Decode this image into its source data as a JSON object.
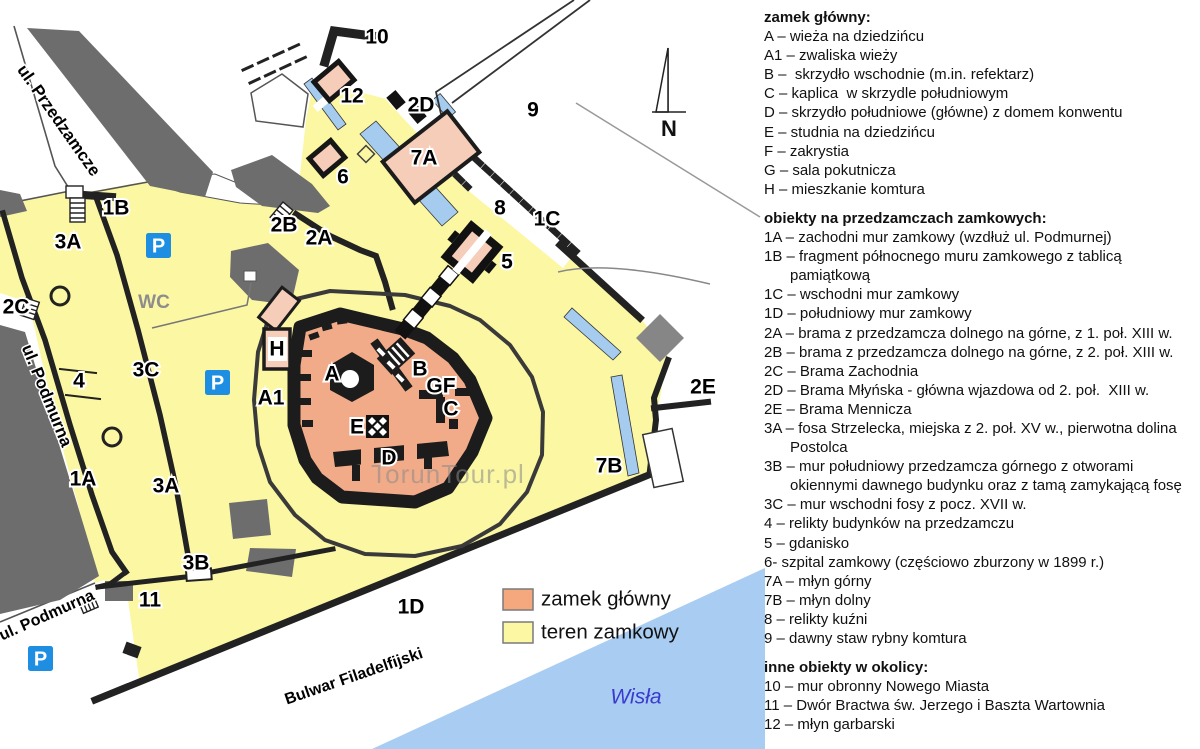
{
  "panel": {
    "sections": [
      {
        "heading": "zamek główny:",
        "lines": [
          {
            "t": "A – wieża na dziedzińcu"
          },
          {
            "t": "A1 – zwaliska wieży"
          },
          {
            "t": "B –  skrzydło wschodnie (m.in. refektarz)"
          },
          {
            "t": "C – kaplica  w skrzydle południowym"
          },
          {
            "t": "D – skrzydło południowe (główne) z domem konwentu"
          },
          {
            "t": "E – studnia na dziedzińcu"
          },
          {
            "t": "F – zakrystia"
          },
          {
            "t": "G – sala pokutnicza"
          },
          {
            "t": "H – mieszkanie komtura"
          }
        ]
      },
      {
        "heading": "obiekty na przedzamczach zamkowych:",
        "lines": [
          {
            "t": "1A – zachodni mur zamkowy (wzdłuż ul. Podmurnej)"
          },
          {
            "t": "1B – fragment północnego muru zamkowego z tablicą"
          },
          {
            "t": "pamiątkową",
            "cont": true
          },
          {
            "t": "1C – wschodni mur zamkowy"
          },
          {
            "t": "1D – południowy mur zamkowy"
          },
          {
            "t": "2A – brama z przedzamcza dolnego na górne, z 1. poł. XIII w."
          },
          {
            "t": "2B – brama z przedzamcza dolnego na górne, z 2. poł. XIII w."
          },
          {
            "t": "2C – Brama Zachodnia"
          },
          {
            "t": "2D – Brama Młyńska - główna wjazdowa od 2. poł.  XIII w."
          },
          {
            "t": "2E – Brama Mennicza"
          },
          {
            "t": "3A – fosa Strzelecka, miejska z 2. poł. XV w., pierwotna dolina"
          },
          {
            "t": "Postolca",
            "cont": true
          },
          {
            "t": "3B – mur południowy przedzamcza górnego z otworami"
          },
          {
            "t": "okiennymi dawnego budynku oraz z tamą zamykającą fosę",
            "cont": true
          },
          {
            "t": "3C – mur wschodni fosy z pocz. XVII w."
          },
          {
            "t": "4 – relikty budynków na przedzamczu"
          },
          {
            "t": "5 – gdanisko"
          },
          {
            "t": "6- szpital zamkowy (częściowo zburzony w 1899 r.)"
          },
          {
            "t": "7A – młyn górny"
          },
          {
            "t": "7B – młyn dolny"
          },
          {
            "t": "8 – relikty kuźni"
          },
          {
            "t": "9 – dawny staw rybny komtura"
          }
        ]
      },
      {
        "heading": "inne obiekty w okolicy:",
        "lines": [
          {
            "t": "10 – mur obronny Nowego Miasta"
          },
          {
            "t": "11 – Dwór Bractwa św. Jerzego i Baszta Wartownia"
          },
          {
            "t": "12 – młyn garbarski"
          }
        ]
      }
    ]
  },
  "map": {
    "labels": [
      {
        "t": "10",
        "x": 377,
        "y": 38
      },
      {
        "t": "12",
        "x": 352,
        "y": 97
      },
      {
        "t": "2D",
        "x": 421,
        "y": 106
      },
      {
        "t": "9",
        "x": 533,
        "y": 111
      },
      {
        "t": "6",
        "x": 343,
        "y": 178
      },
      {
        "t": "7A",
        "x": 424,
        "y": 159
      },
      {
        "t": "8",
        "x": 500,
        "y": 209
      },
      {
        "t": "1C",
        "x": 547,
        "y": 220
      },
      {
        "t": "2B",
        "x": 284,
        "y": 226
      },
      {
        "t": "2A",
        "x": 319,
        "y": 239
      },
      {
        "t": "5",
        "x": 507,
        "y": 263
      },
      {
        "t": "1B",
        "x": 116,
        "y": 209
      },
      {
        "t": "3A",
        "x": 68,
        "y": 243
      },
      {
        "t": "2C",
        "x": 16,
        "y": 308
      },
      {
        "t": "H",
        "x": 277,
        "y": 350
      },
      {
        "t": "A",
        "x": 332,
        "y": 375
      },
      {
        "t": "A1",
        "x": 271,
        "y": 399
      },
      {
        "t": "B",
        "x": 420,
        "y": 370
      },
      {
        "t": "GF",
        "x": 441,
        "y": 387
      },
      {
        "t": "C",
        "x": 451,
        "y": 410
      },
      {
        "t": "E",
        "x": 357,
        "y": 428
      },
      {
        "t": "D",
        "x": 389,
        "y": 459
      },
      {
        "t": "4",
        "x": 79,
        "y": 382
      },
      {
        "t": "3C",
        "x": 146,
        "y": 371
      },
      {
        "t": "1A",
        "x": 83,
        "y": 480
      },
      {
        "t": "3A",
        "x": 166,
        "y": 487
      },
      {
        "t": "3B",
        "x": 196,
        "y": 564
      },
      {
        "t": "11",
        "x": 150,
        "y": 601
      },
      {
        "t": "1D",
        "x": 411,
        "y": 608
      },
      {
        "t": "7B",
        "x": 609,
        "y": 467
      },
      {
        "t": "2E",
        "x": 703,
        "y": 388
      }
    ],
    "street_labels": [
      {
        "t": "ul. Przedzamcze",
        "x": 58,
        "y": 121,
        "r": 55,
        "s": 17
      },
      {
        "t": "ul. Podmurna",
        "x": 46,
        "y": 396,
        "r": 68,
        "s": 17
      },
      {
        "t": "ul. Podmurna",
        "x": 47,
        "y": 616,
        "r": -24,
        "s": 16
      },
      {
        "t": "Bulwar Filadelfijski",
        "x": 354,
        "y": 677,
        "r": -19,
        "s": 16
      }
    ],
    "parking_icons": [
      {
        "x": 146,
        "y": 233
      },
      {
        "x": 205,
        "y": 370
      },
      {
        "x": 28,
        "y": 646
      }
    ],
    "wc_label": "WC",
    "watermark": "TorunTour.pl",
    "compass_label": "N",
    "river_label": "Wisła",
    "legend": [
      {
        "label": "zamek główny",
        "color": "#F5A87D"
      },
      {
        "label": "teren zamkowy",
        "color": "#FBF7A3"
      }
    ]
  },
  "colors": {
    "castle_grounds": "#FBF7A3",
    "main_castle": "#F1AB89",
    "light_building": "#F6CDB8",
    "dark_building": "#6D6D6D",
    "water": "#A9CDF2",
    "parking_blue": "#1E8EE3",
    "river_text": "#3A3ACE",
    "wall": "#1c1c1c"
  }
}
